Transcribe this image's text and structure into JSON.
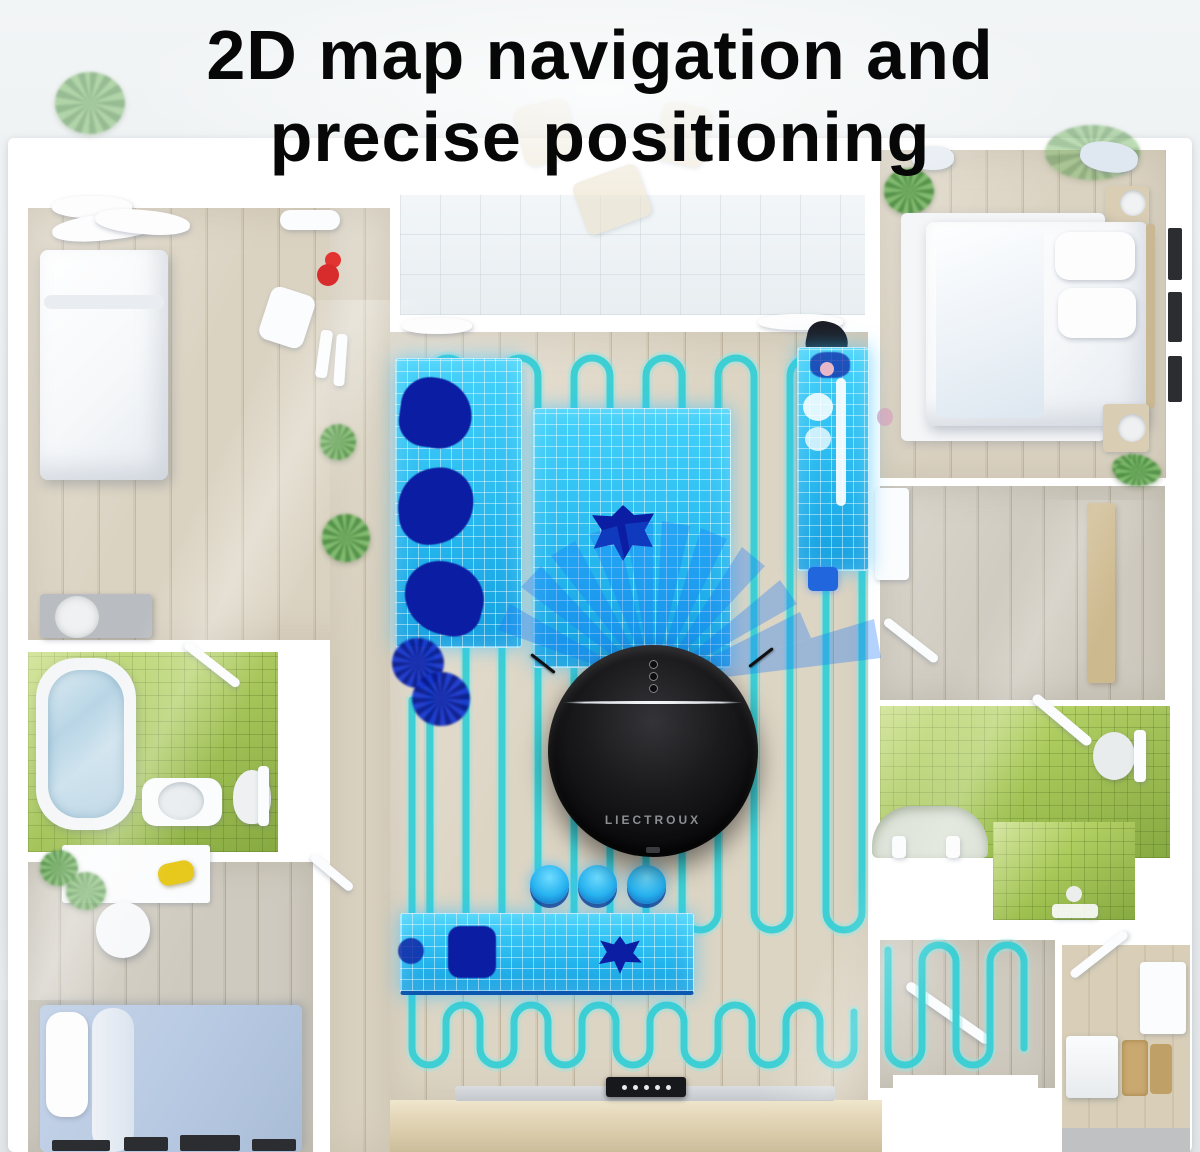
{
  "title": {
    "line1": "2D map navigation and",
    "line2": "precise positioning"
  },
  "robot": {
    "brand": "LIECTROUX",
    "button_count": 3
  },
  "dock": {
    "pin_count": 5
  },
  "colors": {
    "title_black": "#070707",
    "path_cyan": "#3ecfd4",
    "path_glow": "#8fe8e8",
    "zone_blue": "#2cc0f4",
    "zone_object_navy": "#0b1da2",
    "laser_blue": "#1976f8",
    "stool_blue": "#27b2ef",
    "robot_black": "#0d0d0f",
    "robot_brand_gray": "#8b8e92",
    "wall_white": "#ffffff",
    "floor_wood_beige": "#d8d0bf",
    "floor_wood_gray": "#cdc7ba",
    "tile_green": "#a9cb58",
    "counter_wood": "#e3d6b8"
  }
}
